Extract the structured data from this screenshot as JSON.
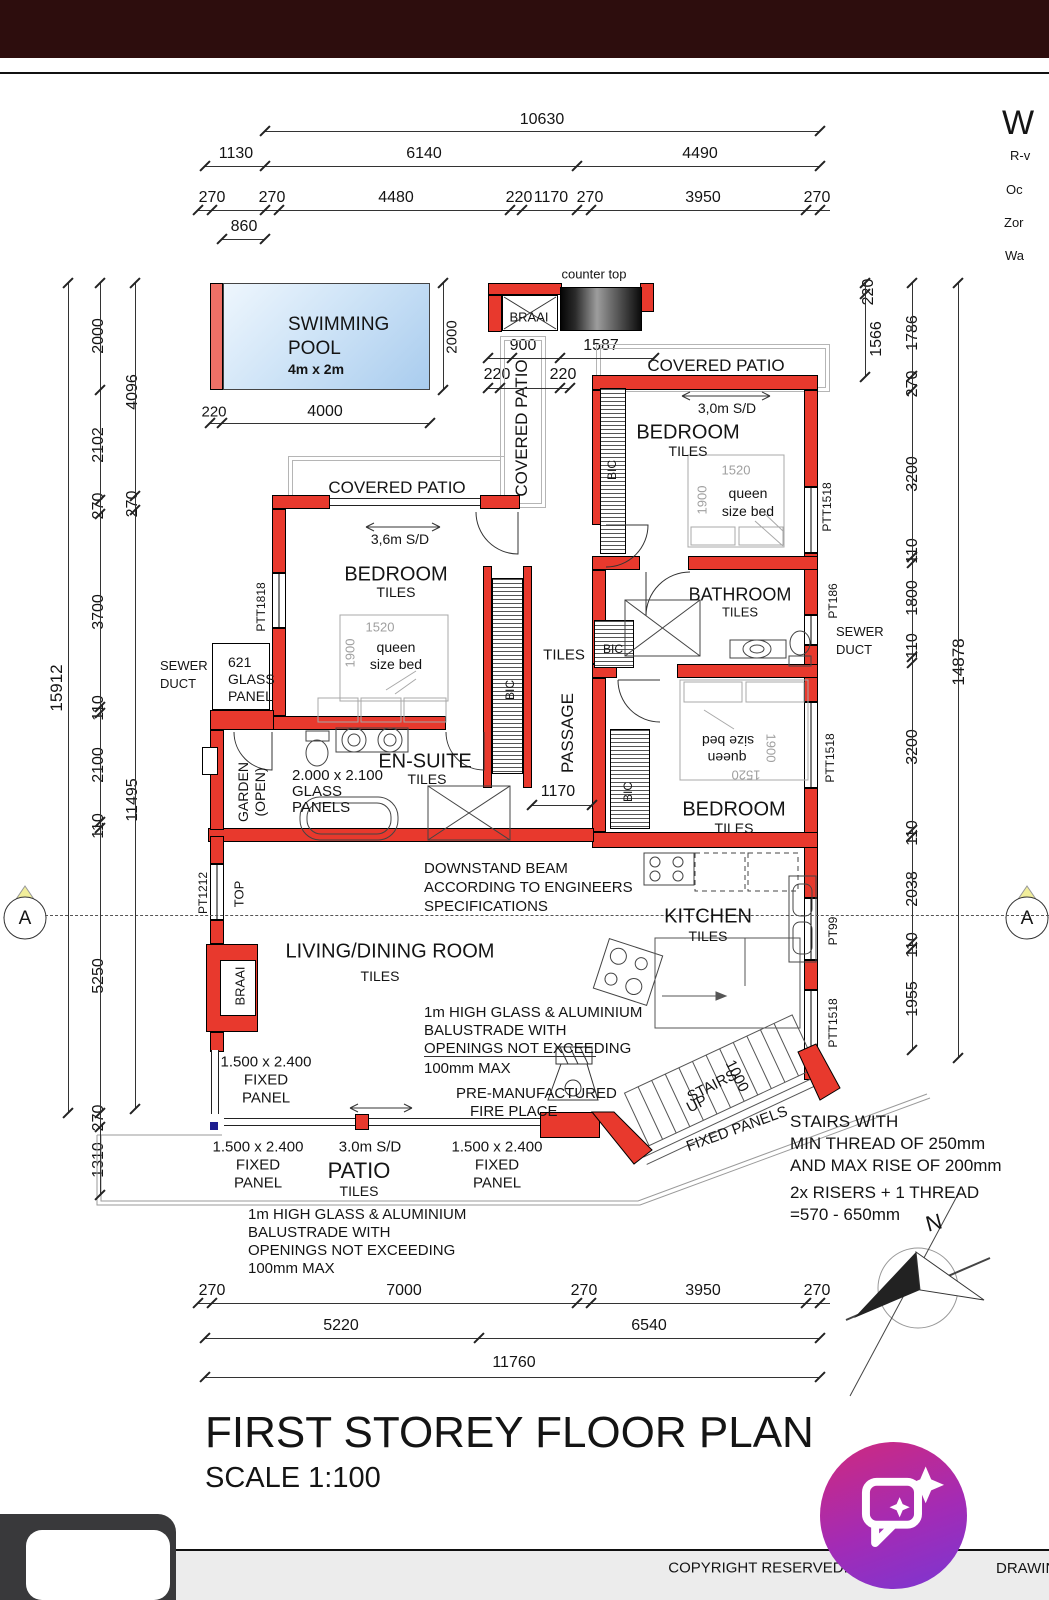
{
  "side_panel": {
    "heading": "W",
    "lines": [
      "R-v",
      "Oc",
      "Zor",
      "Wa"
    ]
  },
  "dims": {
    "top": {
      "total": "10630",
      "row2": [
        "1130",
        "6140",
        "4490"
      ],
      "row3": [
        "270",
        "270",
        "4480",
        "220",
        "1170",
        "270",
        "3950",
        "270"
      ],
      "row4": "860"
    },
    "left": {
      "total": "15912",
      "col_a": [
        "2000",
        "2102",
        "270",
        "3700",
        "110",
        "2100",
        "110",
        "5250",
        "270",
        "1310"
      ],
      "col_b": [
        "4096",
        "270",
        "11495"
      ]
    },
    "right": {
      "total": "14878",
      "col_a": [
        "220",
        "1566"
      ],
      "col_b": [
        "1786",
        "270",
        "3200",
        "110",
        "1800",
        "110",
        "3200",
        "110",
        "2038",
        "110",
        "1955"
      ]
    },
    "bottom": {
      "row1": [
        "270",
        "7000",
        "270",
        "3950",
        "270"
      ],
      "row2": [
        "5220",
        "6540"
      ],
      "row3": "11760"
    },
    "pool": {
      "right": "2000",
      "offset": "220",
      "width": "4000"
    },
    "braai": {
      "w1": "900",
      "w2": "1587",
      "o1": "220",
      "o2": "220"
    },
    "passage": "1170",
    "stairs": "1000"
  },
  "rooms": {
    "pool": {
      "l1": "SWIMMING",
      "l2": "POOL",
      "size": "4m x 2m"
    },
    "bedroom": {
      "name": "BEDROOM",
      "floor": "TILES"
    },
    "bathroom": {
      "name": "BATHROOM",
      "floor": "TILES"
    },
    "ensuite": {
      "name": "EN-SUITE",
      "floor": "TILES"
    },
    "kitchen": {
      "name": "KITCHEN",
      "floor": "TILES"
    },
    "living": {
      "name": "LIVING/DINING ROOM",
      "floor": "TILES"
    },
    "passage": {
      "name": "PASSAGE",
      "floor": "TILES"
    },
    "patio": {
      "name": "PATIO",
      "floor": "TILES"
    },
    "covered_patio": "COVERED PATIO",
    "garden": {
      "l1": "GARDEN",
      "l2": "(OPEN)"
    }
  },
  "fixtures": {
    "bic": "BIC",
    "braai": "BRAAI",
    "counter_top": "counter top",
    "top": "TOP",
    "bed": {
      "w": "1520",
      "d": "1900",
      "l1": "queen",
      "l2": "size bed"
    },
    "sewer": {
      "l1": "SEWER",
      "l2": "DUCT"
    }
  },
  "windows": {
    "ptt1518": "PTT1518",
    "ptt1818": "PTT1818",
    "pt1212": "PT1212",
    "pt186": "PT186",
    "pt99": "PT99"
  },
  "doors": {
    "sd30": "3,0m S/D",
    "sd36": "3,6m S/D",
    "sd30p": "3.0m S/D"
  },
  "notes": {
    "downstand": [
      "DOWNSTAND BEAM",
      "ACCORDING TO ENGINEERS",
      "SPECIFICATIONS"
    ],
    "balustrade": [
      "1m HIGH GLASS & ALUMINIUM",
      "BALUSTRADE WITH",
      "OPENINGS NOT EXCEEDING",
      "100mm MAX"
    ],
    "fixed_panel": [
      "1.500 x 2.400",
      "FIXED",
      "PANEL"
    ],
    "fixed_panels": "FIXED PANELS",
    "fireplace": [
      "PRE-MANUFACTURED",
      "FIRE PLACE"
    ],
    "glass621": [
      "621",
      "GLASS",
      "PANEL"
    ],
    "glass2000": [
      "2.000 x 2.100",
      "GLASS",
      "PANELS"
    ],
    "stairs_dir": [
      "STAIRS",
      "UP"
    ],
    "stairs1": [
      "STAIRS WITH",
      "MIN THREAD OF 250mm",
      "AND MAX RISE OF 200mm"
    ],
    "stairs2": [
      "2x RISERS + 1 THREAD",
      "=570 - 650mm"
    ]
  },
  "compass": {
    "north": "N"
  },
  "section": {
    "label": "A"
  },
  "titleblock": {
    "title": "FIRST STOREY FLOOR PLAN",
    "scale": "SCALE 1:100"
  },
  "footer": {
    "copyright": "COPYRIGHT RESERVED:",
    "right": "DRAWIN"
  }
}
